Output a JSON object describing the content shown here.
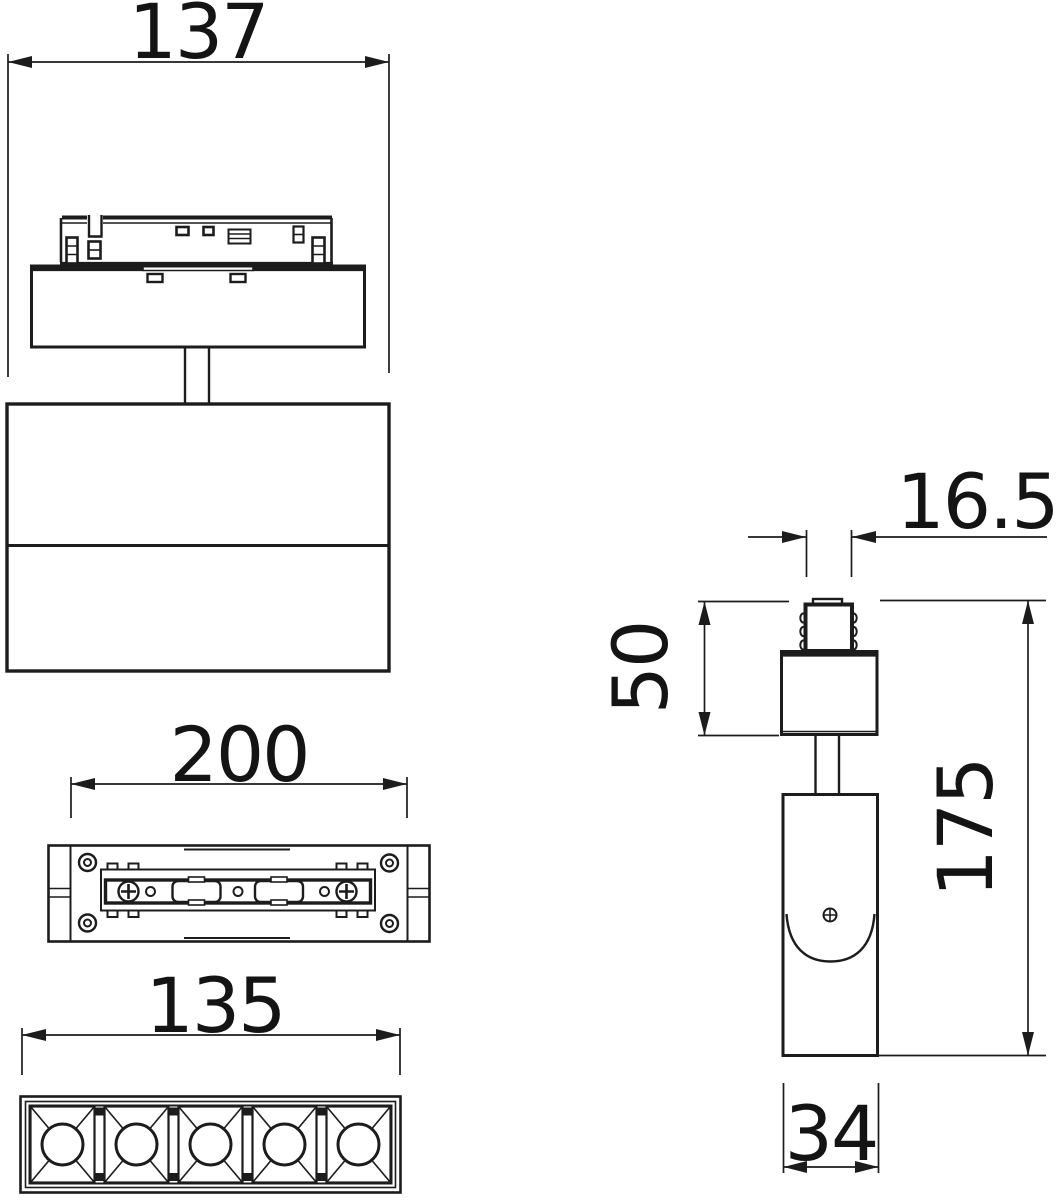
{
  "drawing": {
    "type": "technical-dimension-drawing",
    "subject": "magnetic-track-spotlight-fixture",
    "colors": {
      "line": "#1c1c1c",
      "background": "#ffffff"
    },
    "views": {
      "front": "front-view",
      "track_top": "track-top-view",
      "lens_bottom": "lens-bottom-view",
      "side": "side-view"
    },
    "dimensions": {
      "front_width": "137",
      "track_length": "200",
      "lens_length": "135",
      "adapter_tab_width": "16.5",
      "adapter_height": "50",
      "overall_height": "175",
      "body_depth": "34"
    }
  }
}
